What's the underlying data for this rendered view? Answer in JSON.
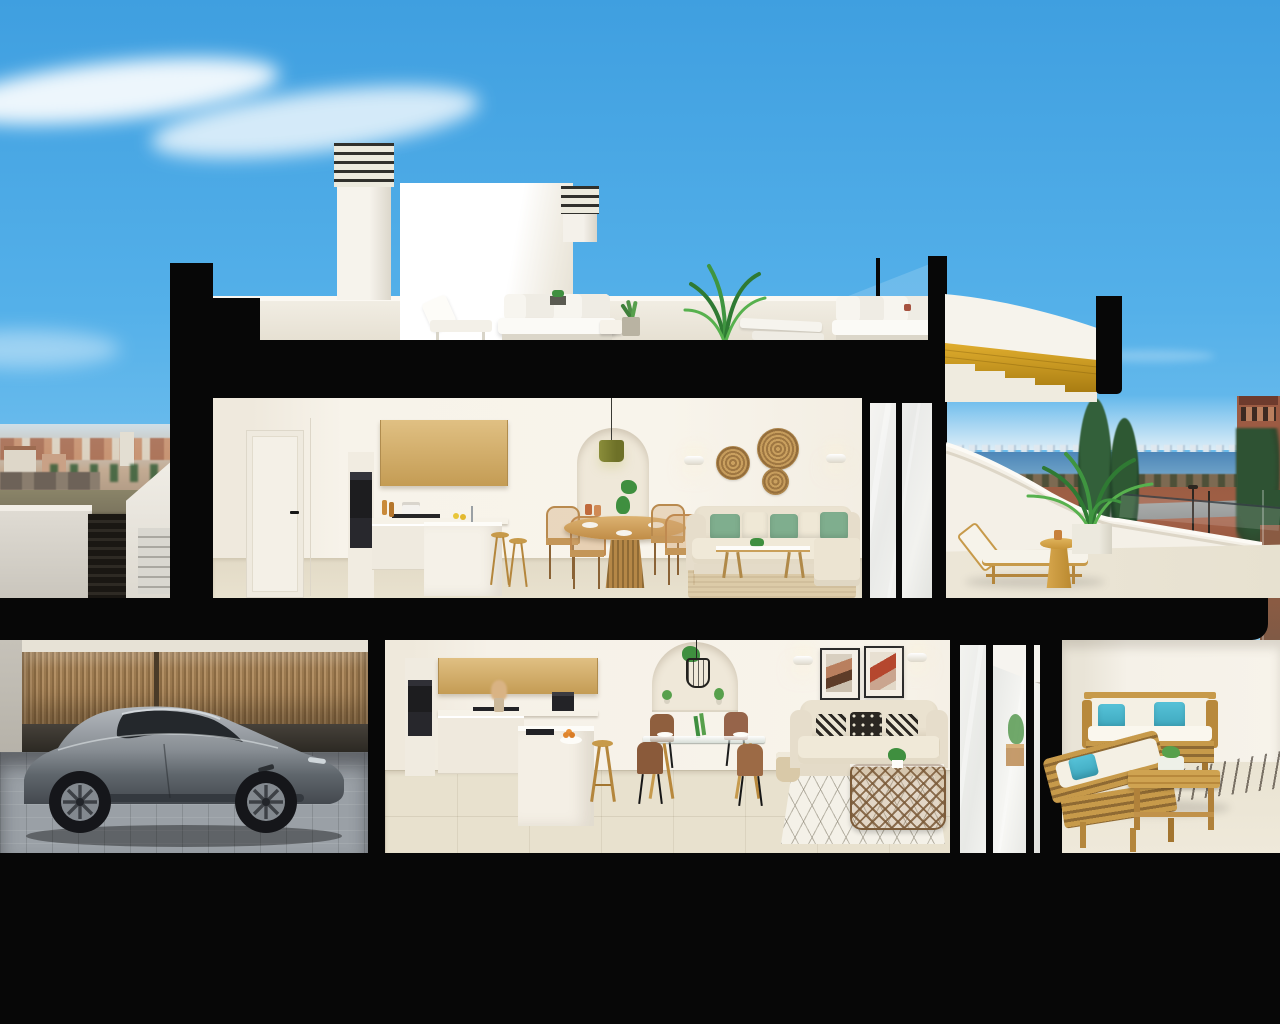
{
  "scene": {
    "type": "architectural-3d-cutaway-render",
    "subject": "Two-storey coastal apartment building cross-section with roof terrace and garage",
    "visible_text": "none",
    "levels": [
      "roof-terrace",
      "upper-apartment",
      "upper-terrace",
      "lower-apartment",
      "lower-terrace",
      "garage"
    ]
  },
  "palette": {
    "sky_top": "#3f9fe0",
    "sky_horizon": "#cfe9f7",
    "cut_black": "#070707",
    "wall_white": "#f6f2e9",
    "wall_shadow": "#e7e0d2",
    "wood_cabinet": "#d7b674",
    "wood_stair": "#cf9a22",
    "wood_furniture": "#c79a4a",
    "floor_tile": "#e8e1ce",
    "terrace_floor": "#ebe5d6",
    "garage_floor": "#9aa0a6",
    "fence_wood": "#a8865c",
    "sofa_cream": "#eae2d0",
    "pillow_green": "#7fae8e",
    "pillow_teal": "#56c2d8",
    "sea": "#4d86b8",
    "dirt_red": "#a26047",
    "town_terracotta": "#b98a6d",
    "tree_green": "#2e5a33",
    "plant_green": "#3f9540",
    "car_grey": "#83898f",
    "appliance_black": "#1d1d1f",
    "art_terracotta": "#b5472e"
  },
  "inventory": {
    "roof": [
      "two louvred chimneys",
      "white rooftop volume",
      "outdoor lounge sets",
      "sun loungers",
      "potted plants",
      "palm plant",
      "glass balustrade",
      "cut-away timber stair with white canopy"
    ],
    "upper_apartment": [
      "white interior door",
      "oak upper cabinets",
      "built-in oven tower",
      "kitchen island with stools",
      "round timber dining table",
      "rattan dining chairs",
      "arched shelf niche with olive pendant",
      "cream corner sofa with green cushions",
      "glass coffee table",
      "jute rug",
      "three wicker wall plates",
      "wall sconces",
      "sliding glass door"
    ],
    "upper_terrace": [
      "curved white parapet",
      "timber sun lounger",
      "timber pedestal side table",
      "potted palm",
      "sea view"
    ],
    "lower_apartment": [
      "oak upper cabinets",
      "oven tower",
      "island with sink and fruit bowl",
      "bar stool",
      "coffee machine",
      "arched shelf niche with cage pendant",
      "glass dining table with four chairs",
      "cream sofa with patterned cushions",
      "two abstract artworks",
      "wall sconces",
      "wicker basket coffee table",
      "diamond pattern rug",
      "sliding glass doors"
    ],
    "lower_terrace": [
      "timber outdoor sofa",
      "timber chaise",
      "teal cushions",
      "timber coffee table with planter",
      "gravel drainage strip"
    ],
    "garage": [
      "grey sports car",
      "timber slat fence",
      "paver floor"
    ]
  },
  "background": [
    "wispy clouds",
    "terracotta hillside town",
    "exterior stair with dark gate",
    "sea horizon with distant skyline",
    "red earth and coastal road",
    "street lamps",
    "cypress trees",
    "watch-tower building"
  ]
}
